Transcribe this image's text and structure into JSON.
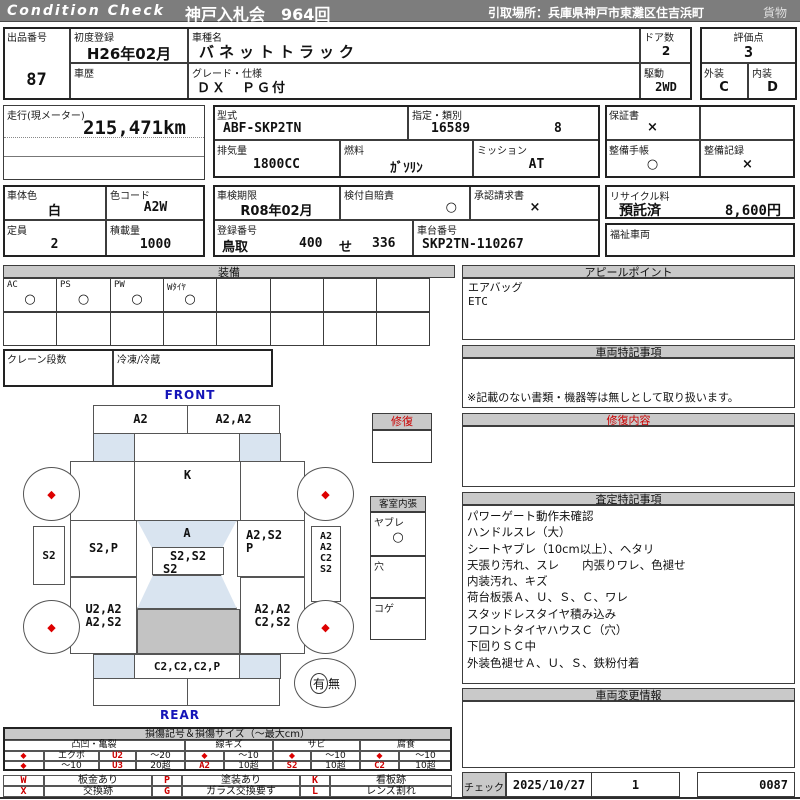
{
  "topbar": {
    "brand": "Condition Check",
    "auction": "神戸入札会　964回",
    "pickup": "引取場所：兵庫県神戸市東灘区住吉浜町",
    "category": "貨物"
  },
  "info": {
    "lot_label": "出品番号",
    "lot": "87",
    "first_reg_label": "初度登録",
    "first_reg": "H26年02月",
    "history_label": "車歴",
    "history": "",
    "model_name_label": "車種名",
    "model_name": "バネットトラック",
    "grade_label": "グレード・仕様",
    "grade": "ＤＸ　ＰＧ付",
    "doors_label": "ドア数",
    "doors": "2",
    "drive_label": "駆動",
    "drive": "2WD",
    "score_label": "評価点",
    "score": "3",
    "ext_label": "外装",
    "ext": "C",
    "int_label": "内装",
    "int": "D",
    "odo_label": "走行(現メーター)",
    "odo": "215,471km",
    "model_code_label": "型式",
    "model_code": "ABF-SKP2TN",
    "class_label": "指定・類別",
    "class1": "16589",
    "class2": "8",
    "disp_label": "排気量",
    "disp": "1800CC",
    "fuel_label": "燃料",
    "fuel": "ｶﾞｿﾘﾝ",
    "mission_label": "ミッション",
    "mission": "AT",
    "warranty_label": "保証書",
    "warranty": "×",
    "book_label": "整備手帳",
    "book": "○",
    "record_label": "整備記録",
    "record": "×",
    "color_label": "車体色",
    "color": "白",
    "color_code_label": "色コード",
    "color_code": "A2W",
    "capacity_label": "定員",
    "capacity": "2",
    "load_label": "積載量",
    "load": "1000",
    "inspection_label": "車検期限",
    "inspection": "R08年02月",
    "insurance_label": "検付自賠責",
    "insurance": "○",
    "approval_label": "承認請求書",
    "approval": "×",
    "reg_label": "登録番号",
    "reg_area": "鳥取",
    "reg_class": "400",
    "reg_kana": "せ",
    "reg_num": "336",
    "chassis_label": "車台番号",
    "chassis": "SKP2TN-110267",
    "recycle_label": "リサイクル料",
    "recycle_status": "預託済",
    "recycle_fee": "8,600円",
    "welfare_label": "福祉車両"
  },
  "equipment": {
    "title": "装備",
    "items": [
      {
        "label": "AC",
        "value": "○"
      },
      {
        "label": "PS",
        "value": "○"
      },
      {
        "label": "PW",
        "value": "○"
      },
      {
        "label": "Wﾀｲﾔ",
        "value": "○"
      },
      {
        "label": "",
        "value": ""
      },
      {
        "label": "",
        "value": ""
      },
      {
        "label": "",
        "value": ""
      },
      {
        "label": "",
        "value": ""
      }
    ],
    "crane_label": "クレーン段数",
    "reefer_label": "冷凍/冷蔵"
  },
  "diagram": {
    "front_label": "FRONT",
    "rear_label": "REAR",
    "front_bumper_left": "A2",
    "front_bumper_right": "A2,A2",
    "roof": "K",
    "door_left": "S2,P",
    "windshield": "A",
    "door_right_line1": "A2,S2",
    "door_right_line2": "P",
    "side_left": "S2",
    "side_right_lines": [
      "A2",
      "A2",
      "C2",
      "S2"
    ],
    "cab_back_line1": "S2,S2",
    "cab_back_line2": "S2",
    "bed_left_line1": "U2,A2",
    "bed_left_line2": "A2,S2",
    "bed_right_line1": "A2,A2",
    "bed_right_line2": "C2,S2",
    "rear_gate": "C2,C2,C2,P",
    "wheel_mark": "◆",
    "spare_yes": "有",
    "spare_no": "無"
  },
  "repair_box": {
    "title": "修復"
  },
  "interior_box": {
    "title": "客室内張",
    "tear_label": "ヤブレ",
    "tear_value": "○",
    "hole_label": "穴",
    "burn_label": "コゲ"
  },
  "right": {
    "appeal_title": "アピールポイント",
    "appeal_items": [
      "エアバッグ",
      "ETC"
    ],
    "notes_title": "車両特記事項",
    "notes_footer": "※記載のない書類・機器等は無しとして取り扱います。",
    "repair_title": "修復内容",
    "assessment_title": "査定特記事項",
    "assessment_items": [
      "パワーゲート動作未確認",
      "ハンドルスレ（大）",
      "シートヤブレ（10cm以上）、ヘタリ",
      "天張り汚れ、スレ　　内張りワレ、色褪せ",
      "内装汚れ、キズ",
      "荷台板張Ａ、Ｕ、Ｓ、Ｃ、ワレ",
      "スタッドレスタイヤ積み込み",
      "フロントタイヤハウスＣ（穴）",
      "下回りＳＣ中",
      "外装色褪せＡ、Ｕ、Ｓ、鉄粉付着"
    ],
    "change_title": "車両変更情報",
    "check_label": "チェック",
    "check_date": "2025/10/27",
    "check_num": "1",
    "check_code": "0087"
  },
  "legend": {
    "title": "損傷記号＆損傷サイズ（〜最大cm）",
    "group_dent": "凸凹・亀裂",
    "group_scratch": "線キズ",
    "group_rust": "サビ",
    "group_corrosion": "腐食",
    "diamond": "◆",
    "dent_r1_name": "エクボ",
    "dent_r1_code": "U2",
    "dent_r1_size": "〜20",
    "dent_r2_size0": "〜10",
    "dent_r2_code": "U3",
    "dent_r2_size": "20超",
    "scratch_r1_size": "〜10",
    "scratch_code": "A2",
    "scratch_r2_size": "10超",
    "rust_r1_size": "〜10",
    "rust_code": "S2",
    "rust_r2_size": "10超",
    "corr_r1_size": "〜10",
    "corr_code": "C2",
    "corr_r2_size": "10超",
    "marks": [
      {
        "code": "W",
        "text": "板金あり"
      },
      {
        "code": "P",
        "text": "塗装あり"
      },
      {
        "code": "K",
        "text": "看板跡"
      },
      {
        "code": "X",
        "text": "交換跡"
      },
      {
        "code": "G",
        "text": "ガラス交換要す"
      },
      {
        "code": "L",
        "text": "レンズ割れ"
      }
    ]
  }
}
